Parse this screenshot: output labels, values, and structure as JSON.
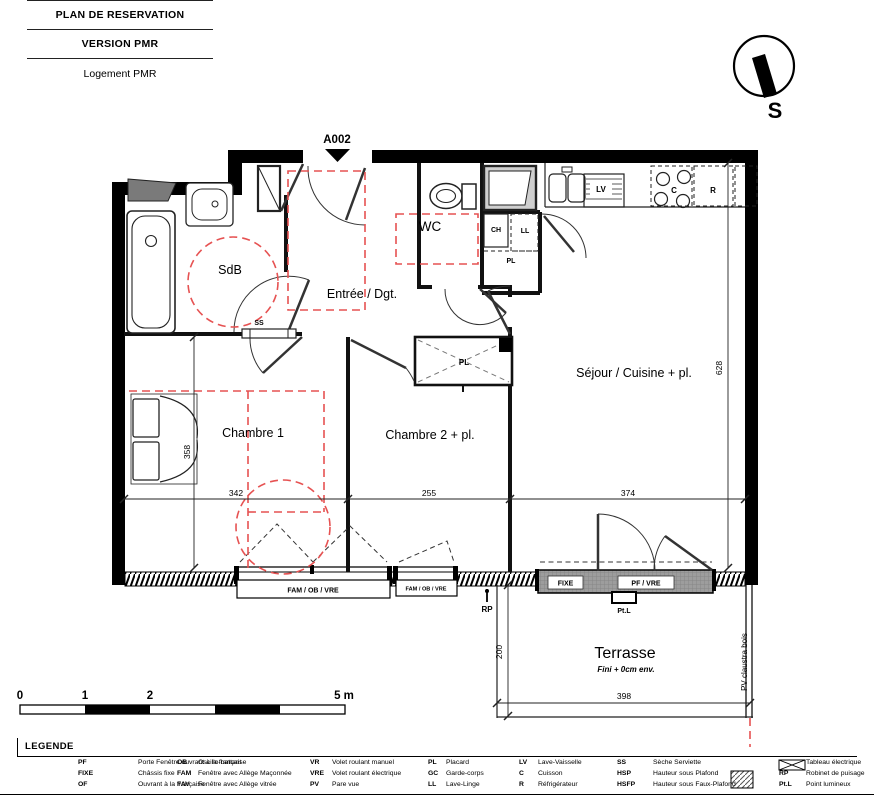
{
  "title_block": {
    "line1": "PLAN DE RESERVATION",
    "line2": "VERSION PMR",
    "line3": "Logement PMR"
  },
  "compass": {
    "south_label": "S"
  },
  "plan": {
    "unit_id": "A002",
    "rooms": {
      "sdb": "SdB",
      "entree": "Entrée / Dgt.",
      "wc": "WC",
      "sejour": "Séjour / Cuisine + pl.",
      "chambre1": "Chambre 1",
      "chambre2": "Chambre 2 + pl.",
      "terrasse": "Terrasse",
      "terrasse_note": "Fini + 0cm env."
    },
    "fixtures": {
      "ch": "CH",
      "ll": "LL",
      "pl_closet": "PL",
      "pl_wardrobe": "PL",
      "lv": "LV",
      "cuisson": "C",
      "refrigerateur": "R",
      "ss": "SS",
      "rp": "RP",
      "ptl": "Pt.L",
      "pv_claustra": "PV claustra bois"
    },
    "windows": {
      "w1": "FAM / OB / VRE",
      "w2": "FAM / OB / VRE",
      "w3_fixe": "FIXE",
      "w3_pf": "PF / VRE"
    },
    "dimensions": {
      "d342": "342",
      "d255": "255",
      "d374": "374",
      "d358": "358",
      "d628": "628",
      "d200": "200",
      "d398": "398"
    }
  },
  "scale_bar": {
    "t0": "0",
    "t1": "1",
    "t2": "2",
    "t5": "5 m"
  },
  "legend": {
    "title": "LEGENDE",
    "columns": [
      {
        "items": [
          {
            "abbr": "PF",
            "label": "Porte Fenêtre ouvrant à la française"
          },
          {
            "abbr": "FIXE",
            "label": "Châssis fixe"
          },
          {
            "abbr": "OF",
            "label": "Ouvrant à la française"
          }
        ]
      },
      {
        "items": [
          {
            "abbr": "OB",
            "label": "Oscillo-battant"
          },
          {
            "abbr": "FAM",
            "label": "Fenêtre avec Allège Maçonnée"
          },
          {
            "abbr": "FAV",
            "label": "Fenêtre avec Allège vitrée"
          }
        ]
      },
      {
        "items": [
          {
            "abbr": "VR",
            "label": "Volet roulant manuel"
          },
          {
            "abbr": "VRE",
            "label": "Volet roulant électrique"
          },
          {
            "abbr": "PV",
            "label": "Pare vue"
          }
        ]
      },
      {
        "items": [
          {
            "abbr": "PL",
            "label": "Placard"
          },
          {
            "abbr": "GC",
            "label": "Garde-corps"
          },
          {
            "abbr": "LL",
            "label": "Lave-Linge"
          }
        ]
      },
      {
        "items": [
          {
            "abbr": "LV",
            "label": "Lave-Vaisselle"
          },
          {
            "abbr": "C",
            "label": "Cuisson"
          },
          {
            "abbr": "R",
            "label": "Réfrigérateur"
          }
        ]
      },
      {
        "items": [
          {
            "abbr": "SS",
            "label": "Sèche Serviette"
          },
          {
            "abbr": "HSP",
            "label": "Hauteur sous Plafond"
          },
          {
            "abbr": "HSFP",
            "label": "Hauteur sous Faux-Plafond"
          }
        ]
      },
      {
        "items": [
          {
            "abbr": "",
            "label": "Tableau électrique"
          },
          {
            "abbr": "RP",
            "label": "Robinet de puisage"
          },
          {
            "abbr": "Pt.L",
            "label": "Point lumineux"
          }
        ]
      }
    ]
  }
}
